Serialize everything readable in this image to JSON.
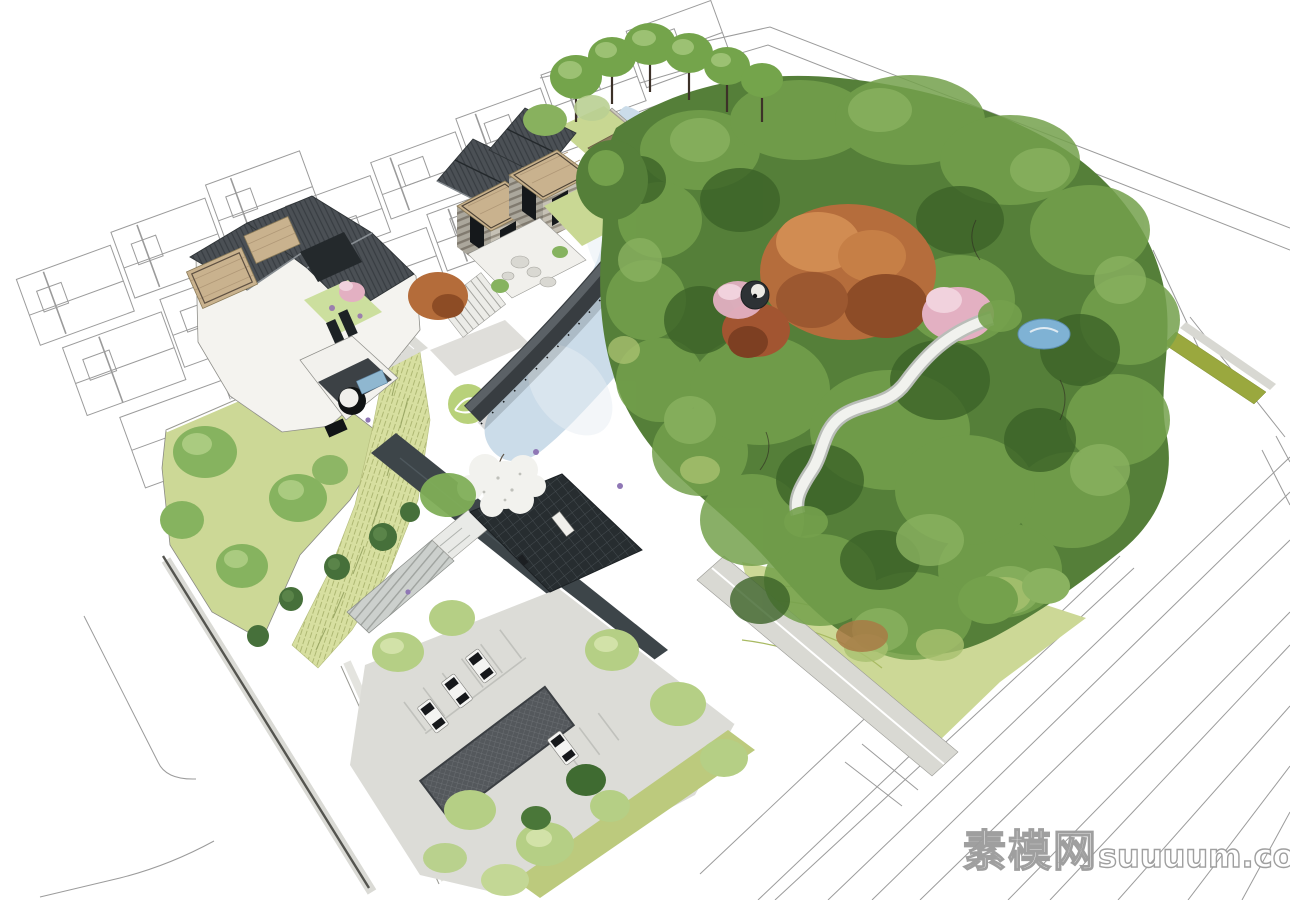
{
  "meta": {
    "description": "Aerial axonometric 3D rendering of a Chinese-style residential landscape: grey-tile-roof villas with wood roof decks, a long dark covered bridge crossing a pale-blue pond, terraced lawn contours, a round waterside pavilion, a winding white path with a small pool inside a dense green tree canopy, an entrance court with glass canopies over a dark water channel, a parking court with cars and a hatched ramp, all placed over white CAD floor-plan and road linework."
  },
  "watermark": {
    "cn": "素模网",
    "latin": "suuuum.com",
    "full": "素模网suuuum.com"
  },
  "palette": {
    "cad": "#9b9b9b",
    "lawn": "#ccd896",
    "lawn_dark": "#a8ba62",
    "meadow": "#d7dfa0",
    "forest": "#557f39",
    "forest_light": "#74a14c",
    "forest_lighter": "#8ab260",
    "forest_dark": "#3c6328",
    "tree_light": "#b5cf85",
    "tree_mid": "#86b35f",
    "shrub_dark": "#46703a",
    "pond": "#cbdce9",
    "canal": "#3d4549",
    "roof": "#4b5055",
    "structure": "#2b3134",
    "wall": "#c9c5bc",
    "wood": "#c9b28e",
    "autumn": "#b56d3c",
    "blossom_pink": "#e3b0c2",
    "blossom_white": "#f2f2ee",
    "paving": "#dcdcd7",
    "path": "#f1f2ee",
    "olive": "#9aa83e",
    "pool": "#7fb2d4",
    "wm_fill": "#ffffff",
    "wm_stroke": "#9c9c9c"
  },
  "scene": {
    "elements": [
      "cad-floor-plans",
      "cad-road-lines",
      "villa-cluster",
      "north-wall-and-gate",
      "covered-bridge",
      "pond",
      "lily-pads",
      "terraced-lawn",
      "round-pavilion",
      "forest-canopy",
      "autumn-trees",
      "pink-blossom-trees",
      "white-blossom-tree",
      "winding-path",
      "small-pool",
      "entrance-canopies",
      "water-channel",
      "west-lawn",
      "grass-meadow-band",
      "parking-court",
      "parked-cars",
      "parking-ramp",
      "street-trees",
      "watermark"
    ]
  }
}
